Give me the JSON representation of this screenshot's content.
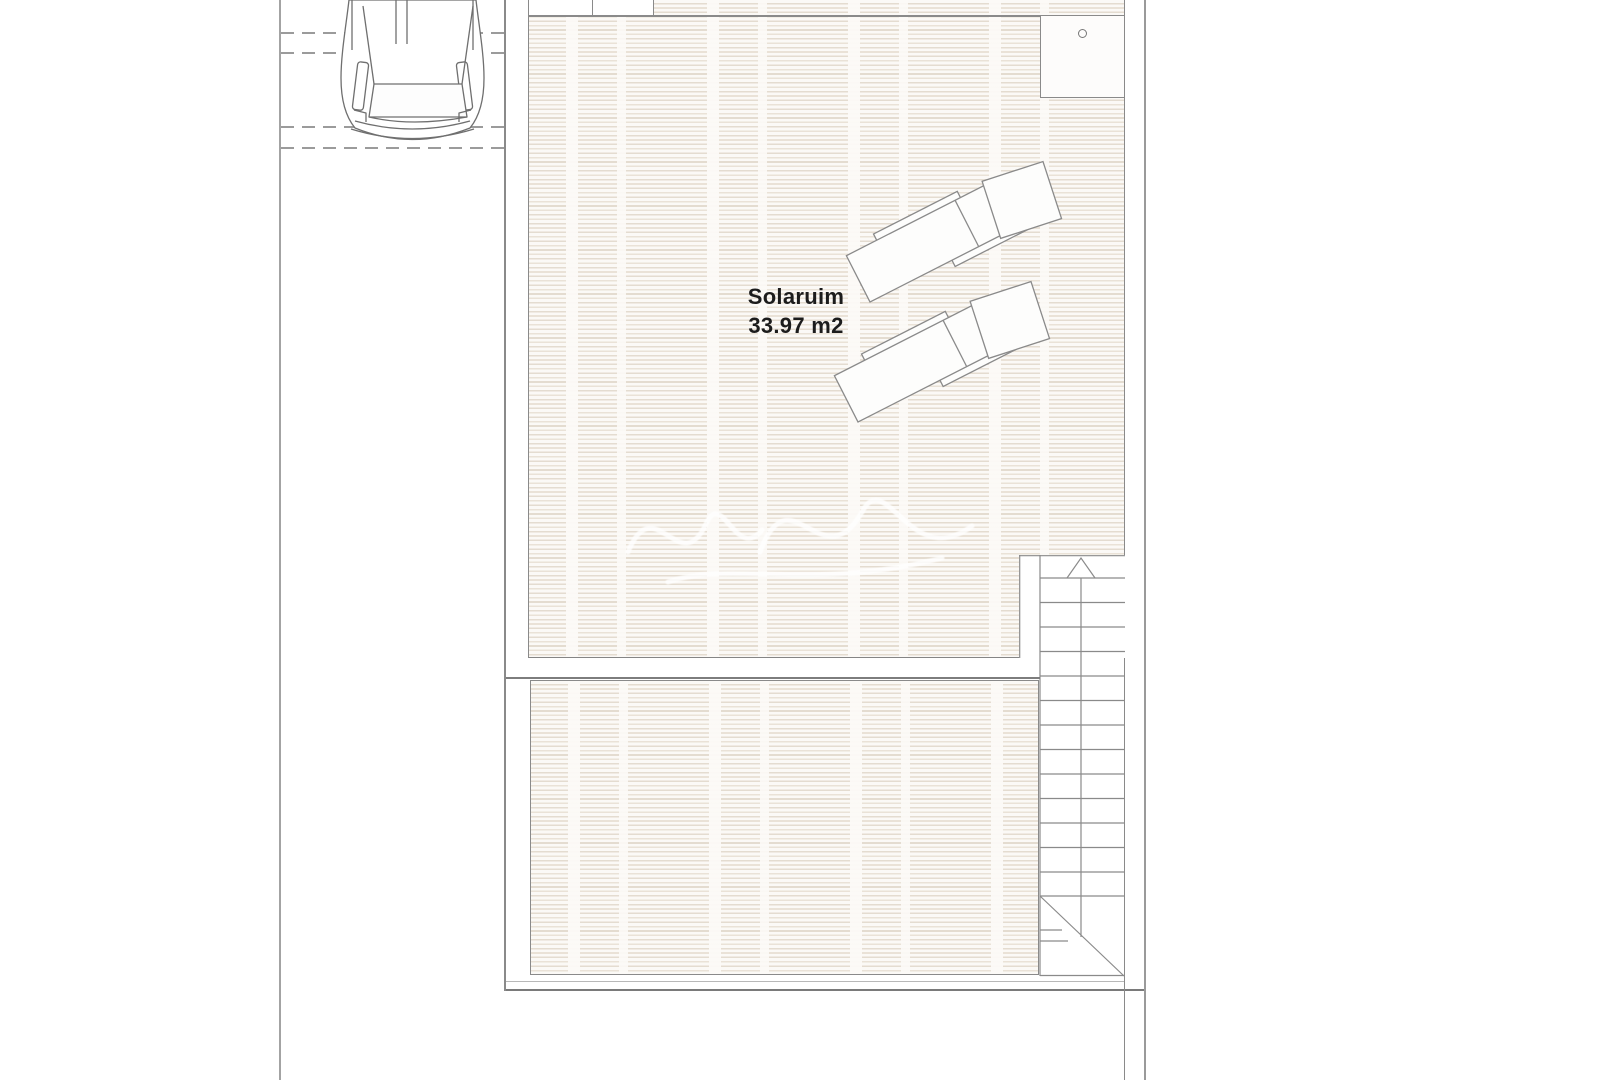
{
  "plan": {
    "room_label": "Solaruim",
    "room_area_label": "33.97 m2"
  },
  "features": {
    "car": "car-top-view",
    "sun_loungers_count": 2,
    "staircase": "two-flight-straight-stairs-with-up-arrow",
    "skylight": "square-box-with-drain-circle",
    "watermark": "faint-white-script"
  },
  "colors": {
    "background": "#ffffff",
    "line_gray": "#8a8a8a",
    "wall_gray": "#7a7a7a",
    "hatch_stripe": "#e4dcd0",
    "hatch_background": "#fbf9f6",
    "label_text": "#1c1c1c",
    "dash_gray": "#9b9b9b"
  }
}
